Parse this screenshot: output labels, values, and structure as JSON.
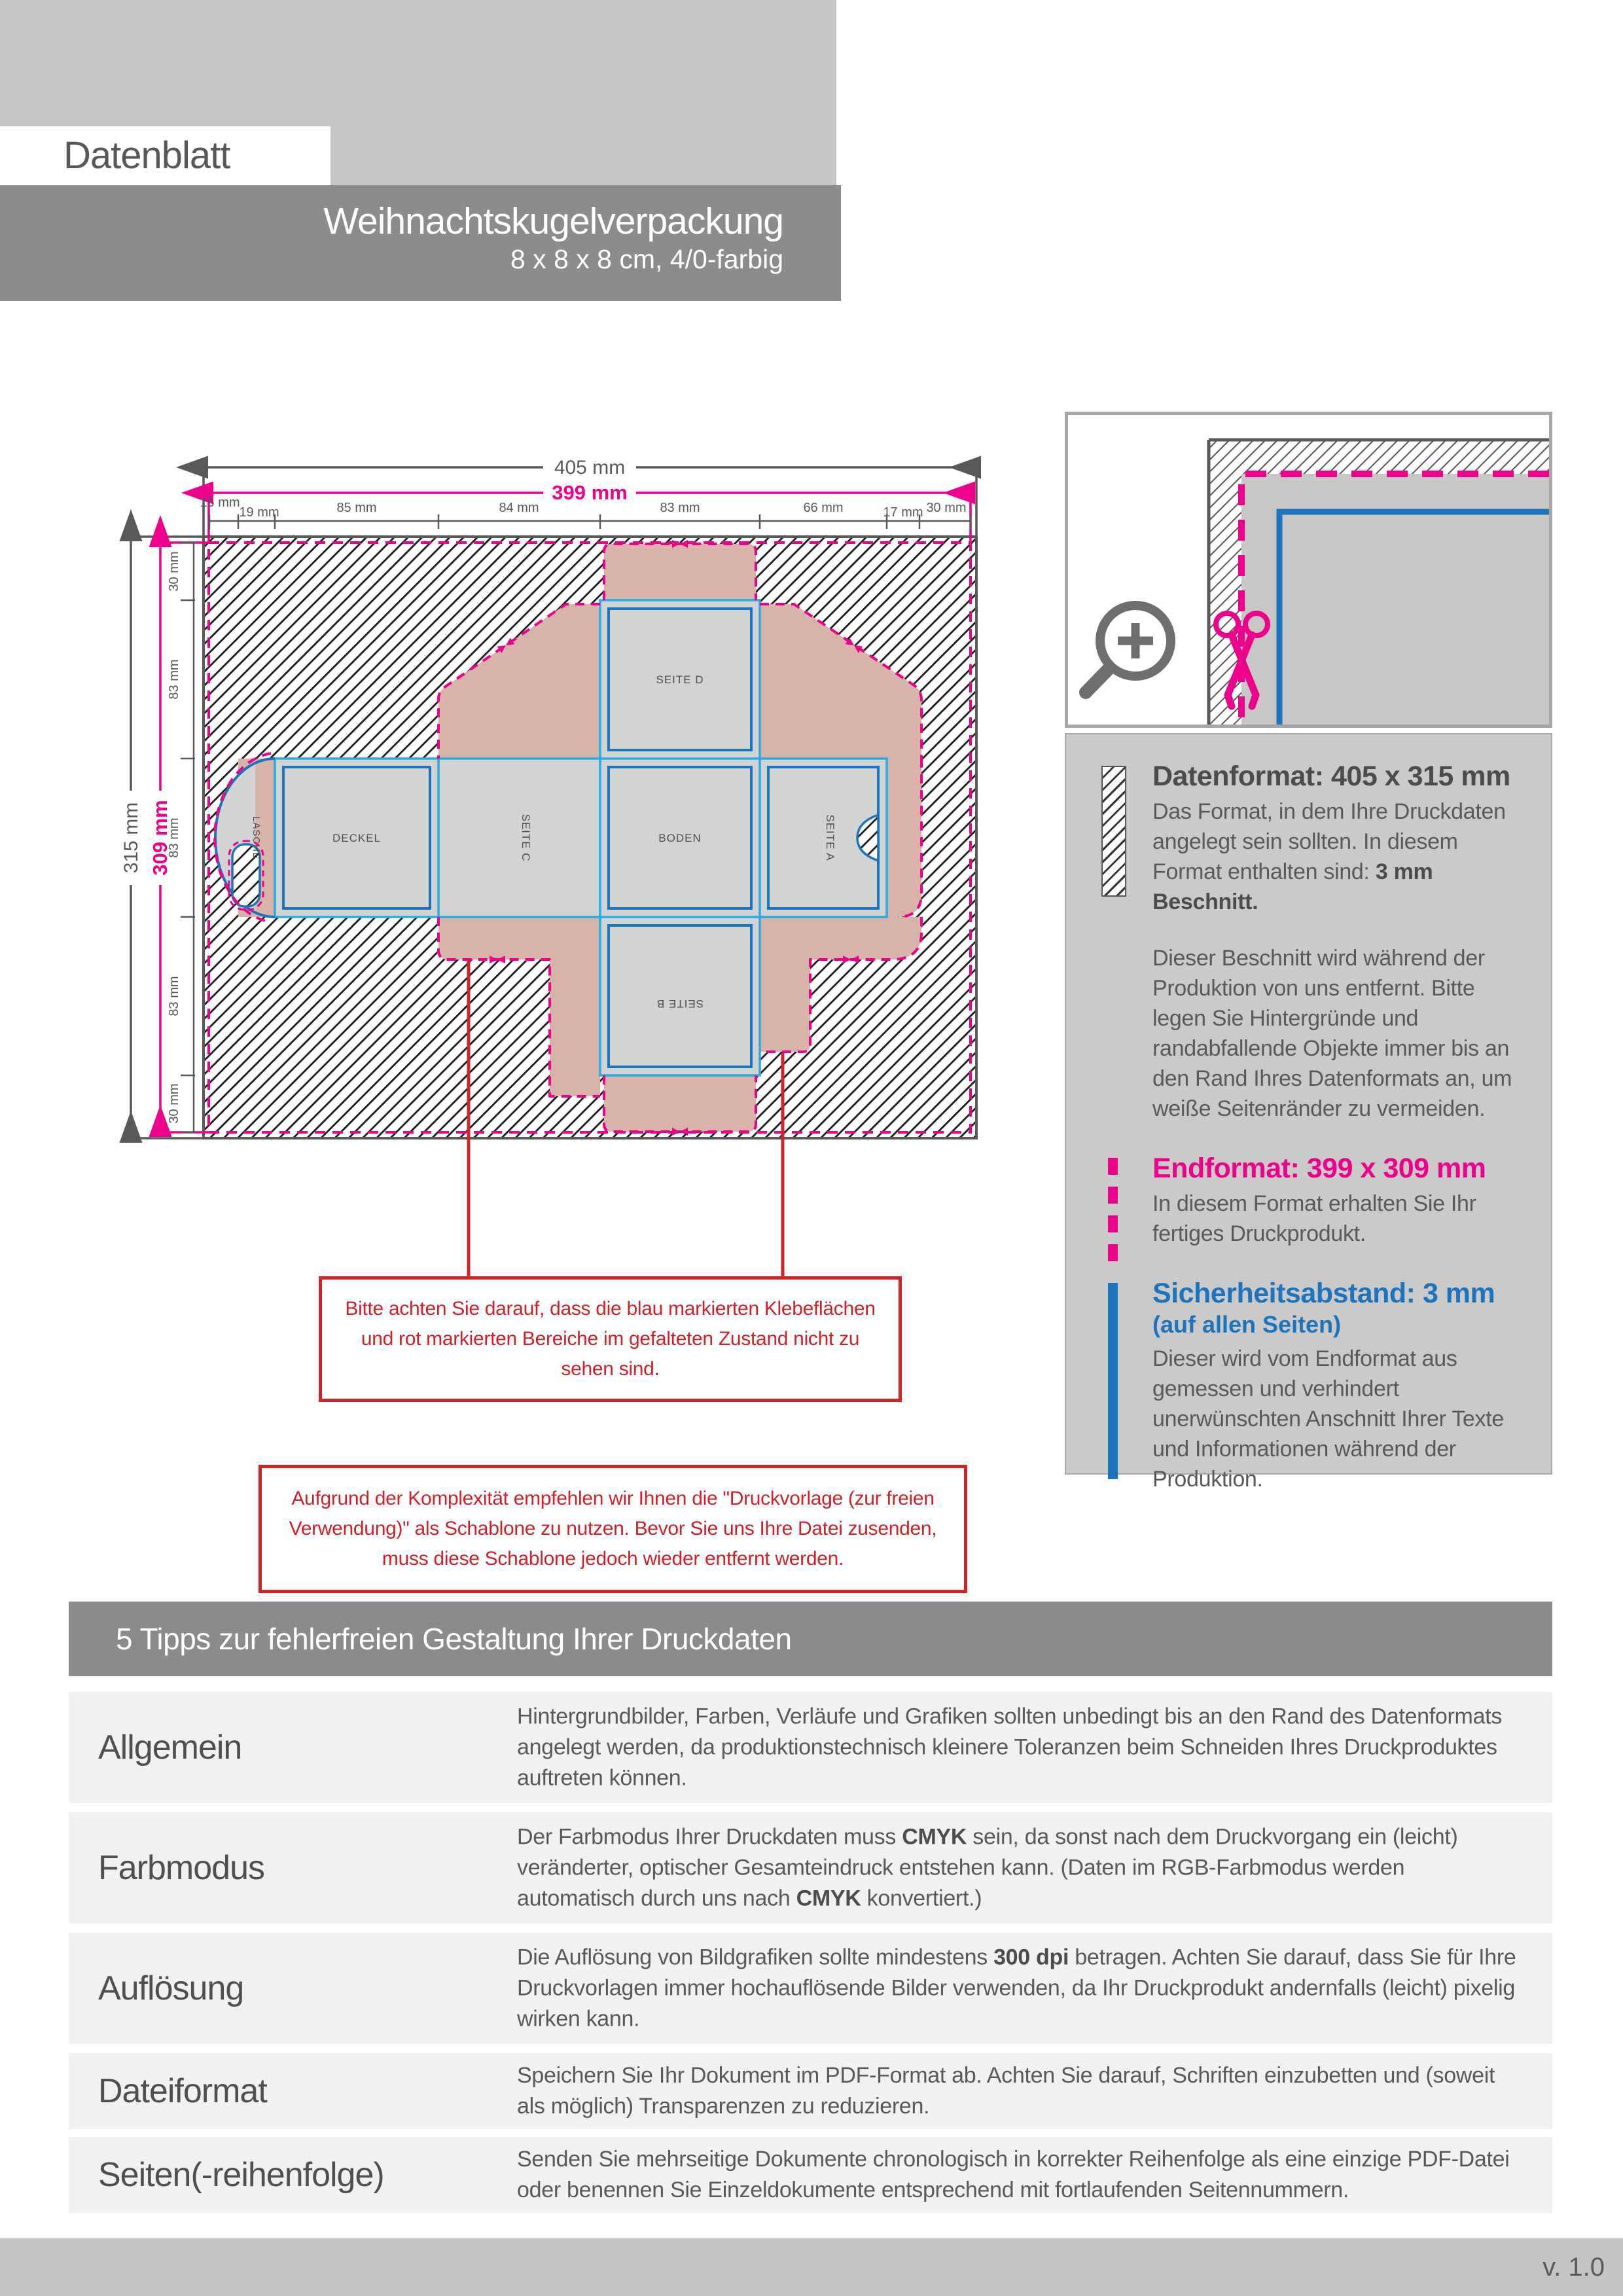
{
  "header": {
    "doc_type": "Datenblatt",
    "product_name": "Weihnachtskugelverpackung",
    "product_spec": "8 x 8 x 8 cm, 4/0-farbig"
  },
  "diagram": {
    "dim_width_outer": "405 mm",
    "dim_width_inner": "399 mm",
    "dim_height_outer": "315 mm",
    "dim_height_inner": "309 mm",
    "ruler_top": [
      "15 mm",
      "19 mm",
      "85 mm",
      "84 mm",
      "83 mm",
      "66 mm",
      "17 mm",
      "30 mm"
    ],
    "ruler_left": [
      "30 mm",
      "83 mm",
      "83 mm",
      "83 mm",
      "30 mm"
    ],
    "panel_labels": {
      "deckel": "DECKEL",
      "seite_c": "SEITE C",
      "boden": "BODEN",
      "seite_a": "SEITE A",
      "seite_d": "SEITE D",
      "seite_b": "SEITE B",
      "lasche": "LASCHE"
    }
  },
  "notes": {
    "klebeflaechen": "Bitte achten Sie darauf, dass die blau markierten Klebeflächen und rot markierten Bereiche im gefalteten Zustand nicht zu sehen sind.",
    "schablone": "Aufgrund der Komplexität empfehlen wir Ihnen die \"Druckvorlage (zur freien Verwendung)\" als Schablone zu nutzen. Bevor Sie uns Ihre Datei zusenden, muss diese Schablone jedoch wieder entfernt werden."
  },
  "info_panel": {
    "datenformat": {
      "title": "Datenformat: 405 x 315 mm",
      "body": "Das Format, in dem Ihre Druckdaten angelegt sein sollten. In diesem Format enthalten sind: **3 mm Beschnitt.**",
      "body2": "Dieser Beschnitt wird während der Produktion von uns entfernt. Bitte legen Sie Hintergründe und randabfallende Objekte immer bis an den Rand Ihres Datenformats an, um weiße Seitenränder zu vermeiden."
    },
    "endformat": {
      "title": "Endformat: 399 x 309 mm",
      "body": "In diesem Format erhalten Sie Ihr fertiges Druckprodukt."
    },
    "sicherheitsabstand": {
      "title": "Sicherheitsabstand: 3 mm",
      "subtitle": "(auf allen Seiten)",
      "body": "Dieser wird vom Endformat aus gemessen und verhindert unerwünschten Anschnitt Ihrer Texte und Informationen während der Produktion."
    }
  },
  "tips": {
    "title": "5 Tipps zur fehlerfreien Gestaltung Ihrer Druckdaten",
    "rows": [
      {
        "label": "Allgemein",
        "text": "Hintergrundbilder, Farben, Verläufe und Grafiken sollten unbedingt bis an den Rand des Datenformats angelegt werden, da produktionstechnisch kleinere Toleranzen beim Schneiden Ihres Druckproduktes auftreten können."
      },
      {
        "label": "Farbmodus",
        "text": "Der Farbmodus Ihrer Druckdaten muss **CMYK** sein, da sonst nach dem Druckvorgang ein (leicht) veränderter, optischer Gesamteindruck entstehen kann. (Daten im RGB-Farbmodus werden automatisch durch uns nach **CMYK** konvertiert.)"
      },
      {
        "label": "Auflösung",
        "text": "Die Auflösung von Bildgrafiken sollte mindestens **300 dpi** betragen. Achten Sie darauf, dass Sie für Ihre Druckvorlagen immer hochauflösende Bilder verwenden, da Ihr Druckprodukt andernfalls (leicht) pixelig wirken kann."
      },
      {
        "label": "Dateiformat",
        "text": "Speichern Sie Ihr Dokument im PDF-Format ab. Achten Sie darauf, Schriften einzubetten und (soweit als möglich) Transparenzen zu reduzieren."
      },
      {
        "label": "Seiten(-reihenfolge)",
        "text": "Senden Sie mehrseitige Dokumente chronologisch in korrekter Reihenfolge als eine einzige PDF-Datei oder benennen Sie Einzeldokumente entsprechend mit fortlaufenden Seitennummern."
      }
    ]
  },
  "footer": {
    "version": "v. 1.0"
  },
  "colors": {
    "magenta": "#ec008c",
    "blue": "#1c75bc",
    "light_blue": "#29abe2",
    "red": "#d2232a",
    "beige": "#d8b3a9",
    "panel_gray": "#d2d4d3",
    "text_gray": "#58595b"
  }
}
